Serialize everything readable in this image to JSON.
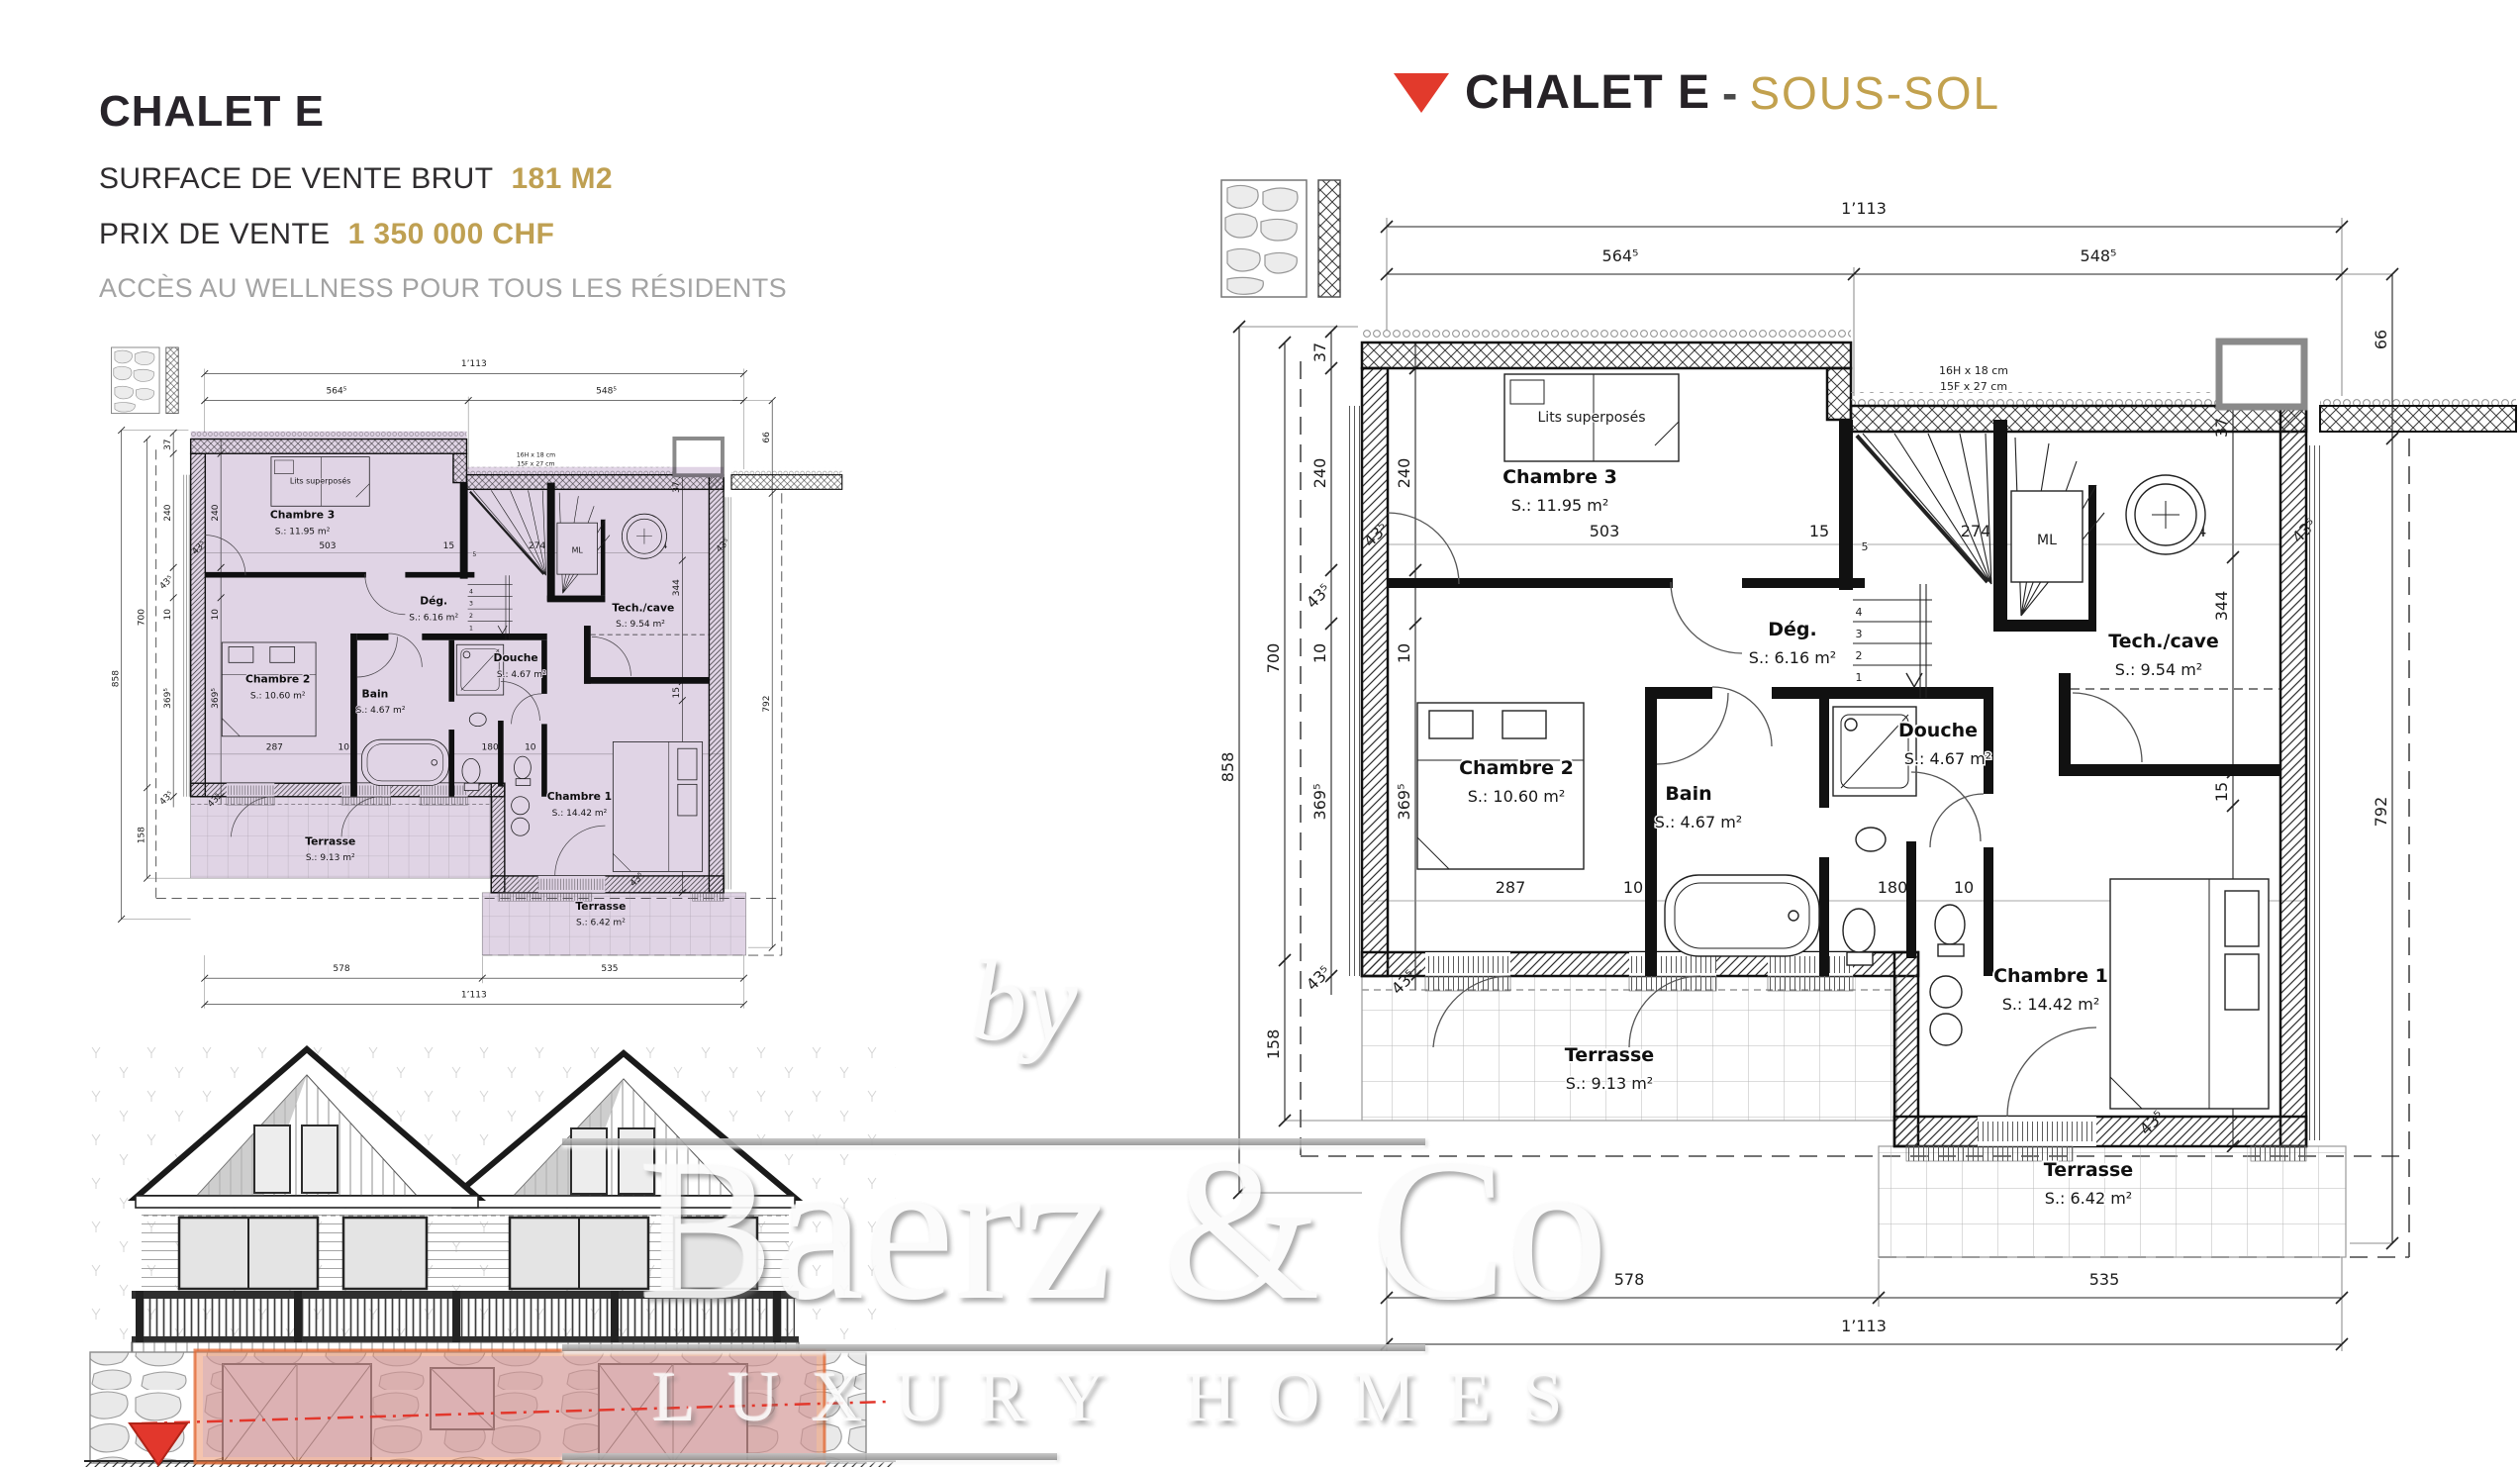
{
  "info": {
    "title": "CHALET E",
    "surface_label": "SURFACE DE VENTE BRUT",
    "surface_value": "181 M2",
    "price_label": "PRIX DE VENTE",
    "price_value": "1 350 000 CHF",
    "note": "ACCÈS AU WELLNESS POUR TOUS LES RÉSIDENTS"
  },
  "header": {
    "title": "CHALET E",
    "separator": "-",
    "subtitle": "SOUS-SOL"
  },
  "watermark": {
    "by": "by",
    "brand": "Baerz & Co",
    "tagline": "LUXURY HOMES"
  },
  "plan": {
    "rooms": {
      "chambre3": {
        "name": "Chambre 3",
        "area": "S.: 11.95 m²"
      },
      "chambre2": {
        "name": "Chambre 2",
        "area": "S.: 10.60 m²"
      },
      "chambre1": {
        "name": "Chambre 1",
        "area": "S.: 14.42 m²"
      },
      "bain": {
        "name": "Bain",
        "area": "S.: 4.67 m²"
      },
      "douche": {
        "name": "Douche",
        "area": "S.: 4.67 m²"
      },
      "degagement": {
        "name": "Dég.",
        "area": "S.: 6.16 m²"
      },
      "tech": {
        "name": "Tech./cave",
        "area": "S.: 9.54 m²"
      },
      "terrasse1": {
        "name": "Terrasse",
        "area": "S.: 9.13 m²"
      },
      "terrasse2": {
        "name": "Terrasse",
        "area": "S.: 6.42 m²"
      }
    },
    "furniture": {
      "bunk": "Lits superposés",
      "ml": "ML"
    },
    "stairs": {
      "line1": "16H x 18 cm",
      "line2": "15F x 27 cm",
      "numbers": [
        "1",
        "2",
        "3",
        "4",
        "5"
      ]
    },
    "dims": {
      "total": "1’113",
      "segLeft": "564⁵",
      "segRight": "548⁵",
      "botLeft": "578",
      "botRight": "535",
      "h858": "858",
      "h700": "700",
      "h158": "158",
      "w37": "37",
      "h240": "240",
      "d435": "43⁵",
      "t10": "10",
      "h3695": "369⁵",
      "w503": "503",
      "w15": "15",
      "w274": "274",
      "w234": "234",
      "h344": "344",
      "h792": "792",
      "w287": "287",
      "w180": "180",
      "w349": "349",
      "h3525": "352⁵",
      "w66": "66"
    }
  },
  "colors": {
    "gold": "#bfa052",
    "red": "#e23a2c",
    "purple_tint": "#c2a9cc",
    "orange_tint": "#ec8a5e",
    "text_dark": "#28242a",
    "text_grey": "#a3a3a3"
  }
}
